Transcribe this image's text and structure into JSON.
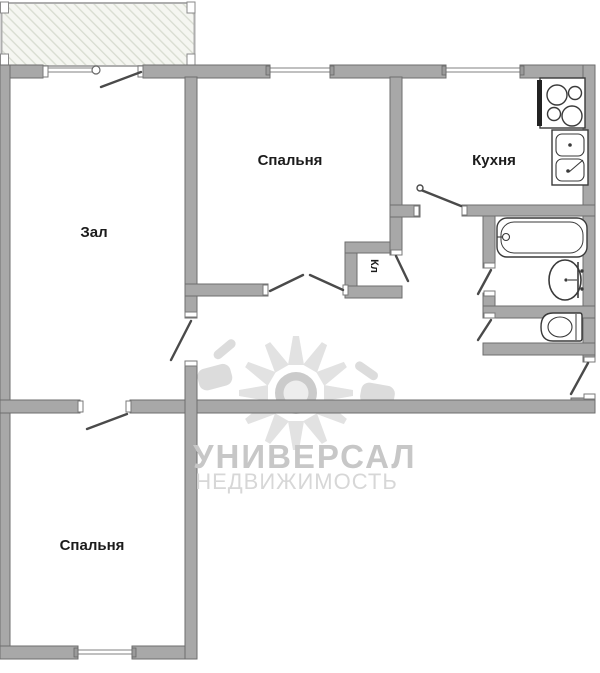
{
  "floor_plan": {
    "rooms": {
      "living_room": {
        "label": "Зал"
      },
      "bedroom_top": {
        "label": "Спальня"
      },
      "kitchen": {
        "label": "Кухня"
      },
      "closet": {
        "label": "Кл"
      },
      "bedroom_bottom": {
        "label": "Спальня"
      }
    },
    "fixtures": [
      "stove-icon",
      "kitchen-sink-icon",
      "bathtub-icon",
      "washbasin-icon",
      "toilet-icon"
    ],
    "colors": {
      "wall": "#a8a8a8",
      "wall_outline": "#6e6e6e",
      "door_line": "#4a4a4a",
      "fixture_outline": "#3a3a3a",
      "balcony_hatch": "#d9ddd2",
      "watermark_text": "#c7c7c7",
      "watermark_logo": "#e0e0e0"
    }
  },
  "watermark": {
    "line1": "УНИВЕРСАЛ",
    "line2": "НЕДВИЖИМОСТЬ"
  }
}
